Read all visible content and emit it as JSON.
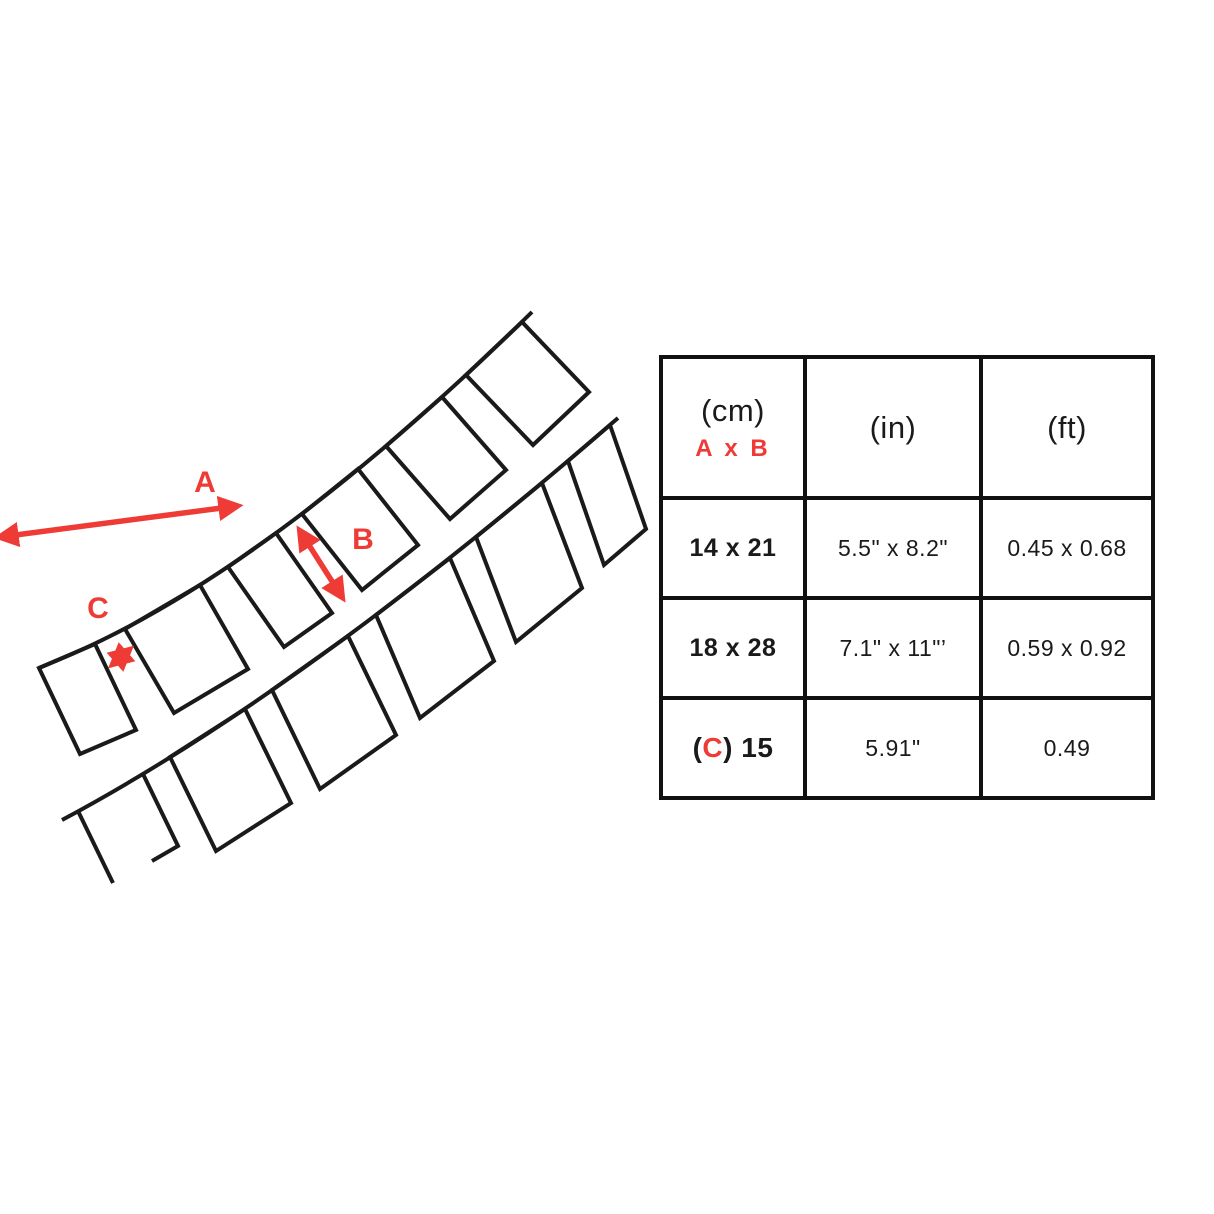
{
  "accent_color": "#EF3B36",
  "line_color": "#1A1A1A",
  "diagram": {
    "label_a": "A",
    "label_b": "B",
    "label_c": "C"
  },
  "table": {
    "header": {
      "col1_unit": "(cm)",
      "col1_sub": "A x B",
      "col2_unit": "(in)",
      "col3_unit": "(ft)"
    },
    "rows": [
      {
        "cm": "14 x 21",
        "in": "5.5\" x 8.2\"",
        "ft": "0.45 x 0.68"
      },
      {
        "cm": "18 x 28",
        "in": "7.1\" x 11\"’",
        "ft": "0.59 x 0.92"
      },
      {
        "cm_prefix": "(",
        "cm_c": "C",
        "cm_suffix": ") 15",
        "in": "5.91\"",
        "ft": "0.49"
      }
    ]
  }
}
